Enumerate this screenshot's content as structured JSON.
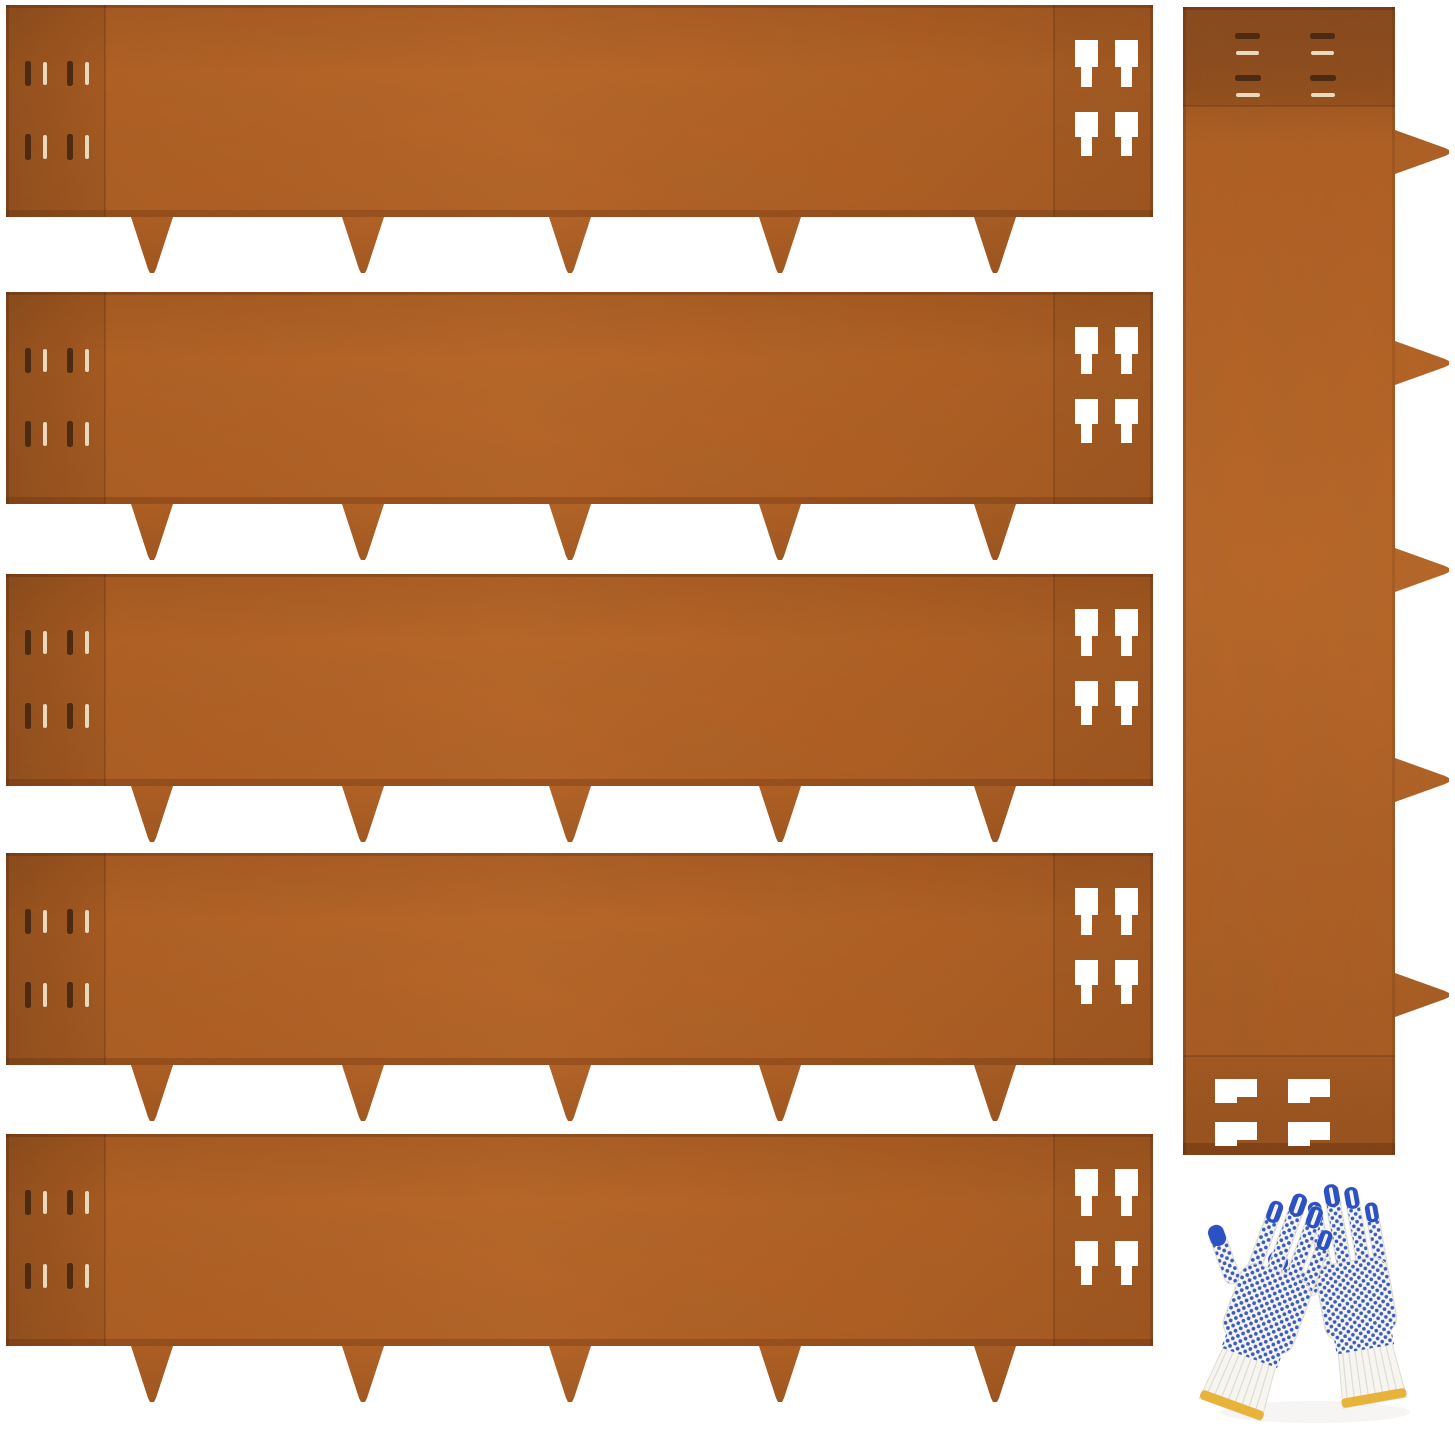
{
  "image": {
    "type": "product-photo",
    "subject": "Corten steel landscape edging strips with ground spikes, shown with a pair of PVC-dot knit work gloves",
    "background_color": "#ffffff"
  },
  "items": {
    "horizontal_strips": {
      "count": 5,
      "spikes_each": 5,
      "left_slit_rows": 2,
      "slits_per_row": 4,
      "right_connector_cutouts": 4
    },
    "vertical_strip": {
      "count": 1,
      "spikes": 5,
      "spike_direction": "right",
      "top_slit_columns": 2,
      "bottom_connector_cutouts": 4
    },
    "gloves": {
      "pairs": 1,
      "style": "white knit with blue PVC grip dots",
      "fingertips": "blue coated",
      "cuff_trim": "yellow band"
    }
  },
  "colors": {
    "bg": "#ffffff",
    "rust_main": "#b25d20",
    "rust_light": "#bb6526",
    "rust_medium": "#a8581f",
    "rust_dark": "#9c521d",
    "rust_deepest": "#8f4b1c",
    "edge_shadow": "#7e3e14",
    "slit_dark": "#4d2a12",
    "slit_light": "#ead9bd",
    "glove_white": "#f6f5f0",
    "glove_shade": "#dfddd4",
    "glove_dot": "#3a5cc0",
    "glove_tip": "#2c51c5",
    "glove_trim": "#e9b23a"
  }
}
